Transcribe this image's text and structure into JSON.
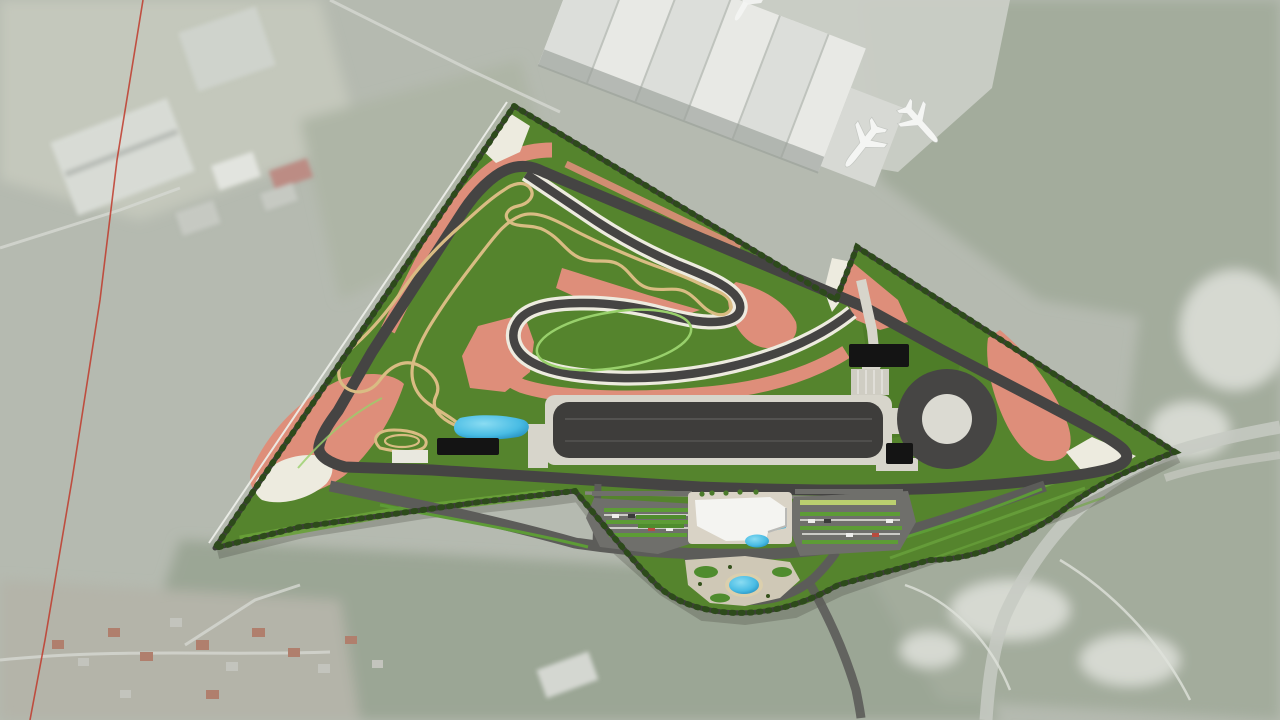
{
  "view": {
    "type": "aerial-satellite-render",
    "width_px": 1280,
    "height_px": 720
  },
  "site": {
    "kind": "proving-ground-race-circuit-masterplan",
    "features": [
      "main-circuit",
      "handling-course",
      "offroad-trail",
      "dynamic-platform",
      "skid-pad-circle",
      "wet-pool",
      "workshop-buildings",
      "visitor-building",
      "parking-lots",
      "ornamental-pond",
      "gardens",
      "perimeter-road",
      "tree-line"
    ]
  },
  "airport": {
    "hangar": true,
    "airplanes_parked": 2,
    "airplanes_partial": 1
  },
  "background": {
    "red_survey_line": true,
    "highway": true,
    "village": true,
    "woods": true,
    "warehouses": true
  },
  "colors": {
    "background_base": "#b5bab0",
    "woods": "#a3ac9c",
    "woods_dark": "#95a08e",
    "field_light": "#c4c8bc",
    "airport_apron": "#cacdc6",
    "hangar_white": "#e8e9e5",
    "hangar_shadow": "#9aa09a",
    "warehouse": "#d8dbd5",
    "plane_white": "#f4f5f3",
    "highway": "#c7cac3",
    "rock_light": "#d6d9d1",
    "village_ground": "#b4b4a9",
    "roof_red": "#b07f6d",
    "red_survey_line": "#c0392b",
    "site_green": "#55842d",
    "green_bright": "#69a138",
    "green_dark": "#44711f",
    "tree_line": "#2d4a1b",
    "perimeter_road": "#3e3e3a",
    "boundary_white": "#eceee8",
    "track_asphalt": "#454443",
    "runoff_red": "#de8e7a",
    "runoff_white": "#edebdf",
    "trail_tan": "#d9bc83",
    "mow_line_green": "#98d06b",
    "platform_asphalt": "#3e3d3b",
    "concrete_apron": "#d7d5cb",
    "skidpad_ring": "#464544",
    "skidpad_center": "#dbdad2",
    "building_black": "#141414",
    "building_white": "#f4f4f1",
    "pool_blue": "#49bce4",
    "pool_deep": "#1d86b8",
    "pond_beach": "#dbcfad",
    "plaza": "#cfc8b6",
    "road": "#5c5c59",
    "parking_lot": "#6f6f6b",
    "hedge_green": "#5d9c36",
    "hedge_yellow": "#bacf6f",
    "stall_white": "#dcdcd6",
    "car_white": "#eeeeec",
    "car_red": "#b84b3e",
    "car_dark": "#3a3a3a",
    "pit_lane": "#85857f"
  }
}
